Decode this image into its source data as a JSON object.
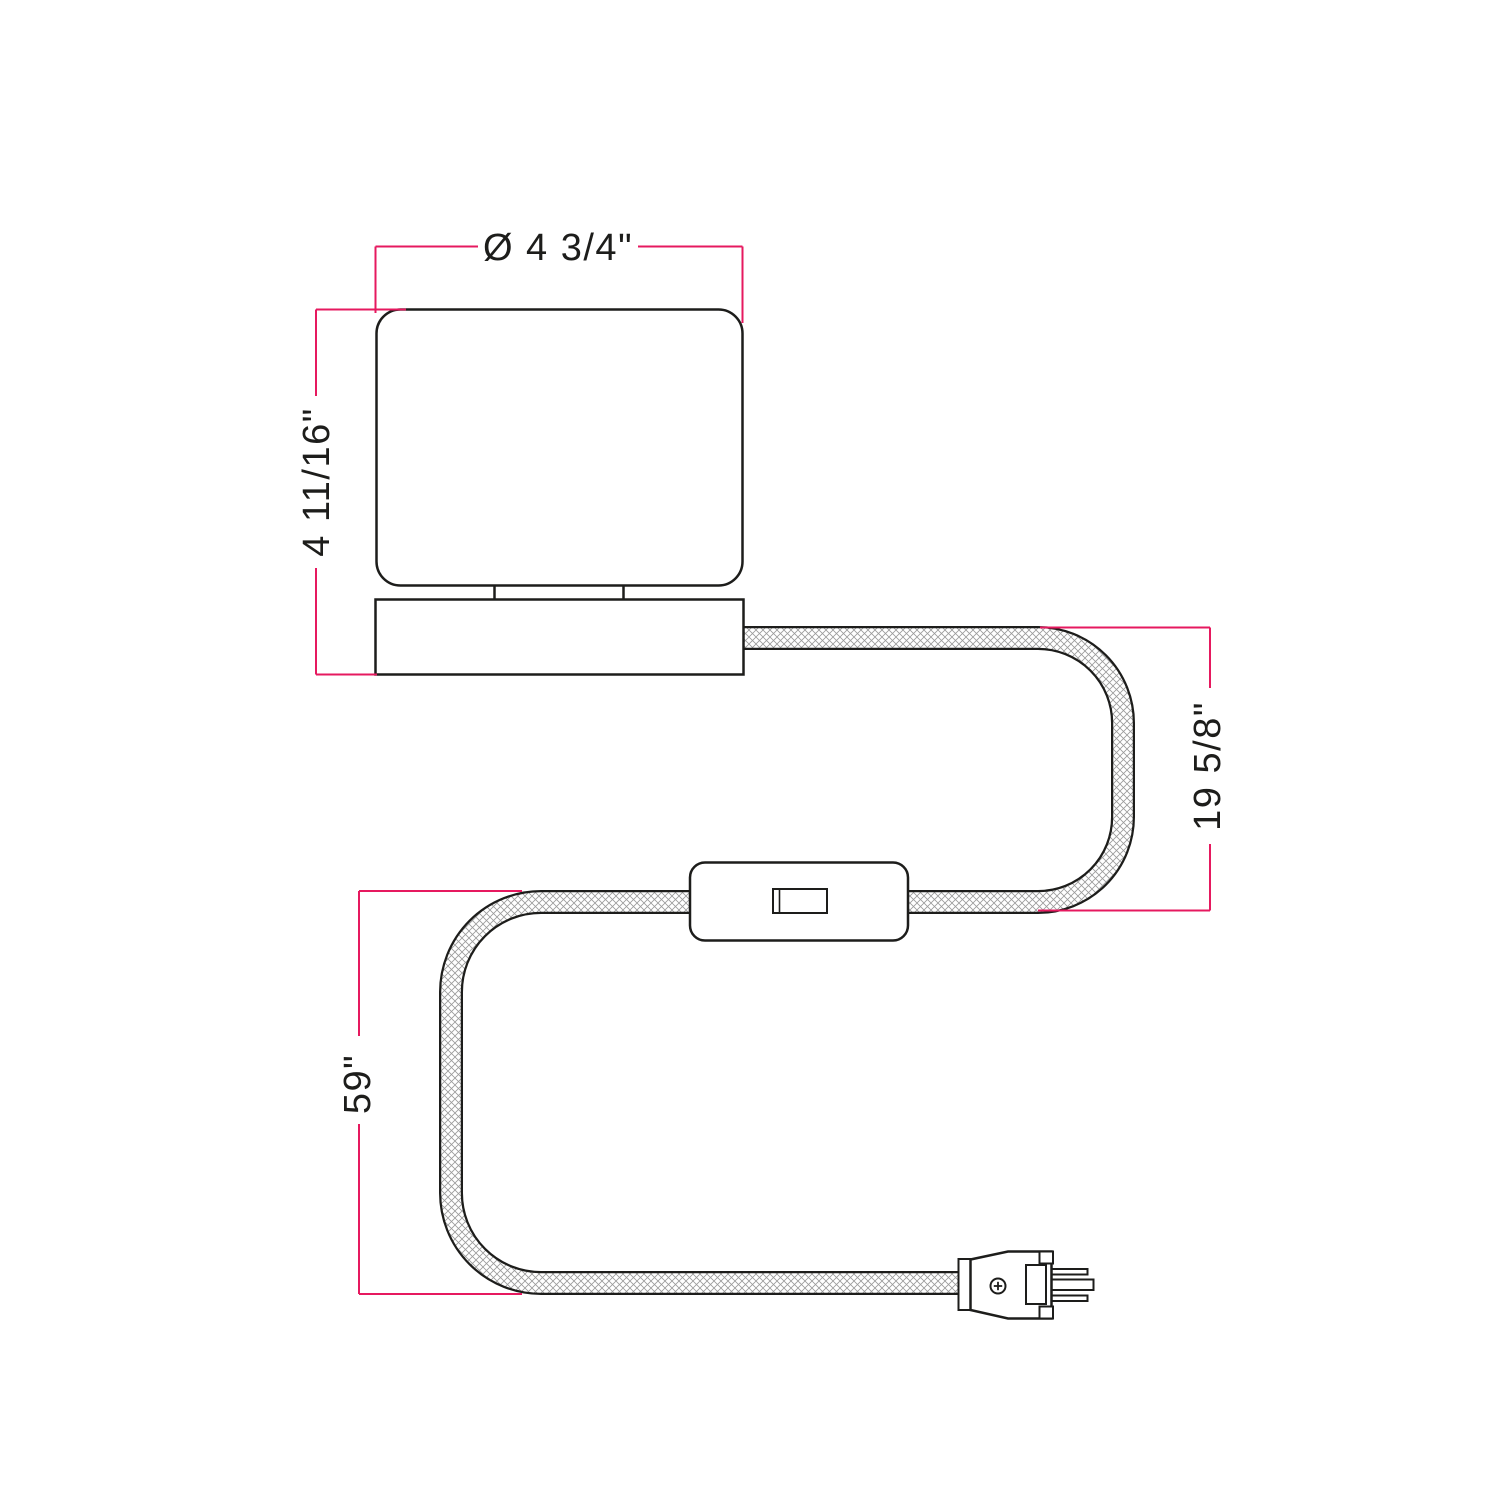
{
  "diagram": {
    "kind": "product-dimension-drawing",
    "product": "table lamp with fabric cord, inline switch and grounded plug",
    "colors": {
      "outline": "#1d1d1b",
      "dimension": "#e6195f",
      "cord_hatch": "#9a9a9a",
      "background": "#ffffff"
    },
    "dimensions": {
      "shade_diameter": {
        "label": "Ø 4 3/4\"",
        "orientation": "horizontal"
      },
      "lamp_height": {
        "label": "4 11/16\"",
        "orientation": "vertical"
      },
      "cord_drop": {
        "label": "19 5/8\"",
        "orientation": "vertical"
      },
      "cord_length": {
        "label": "59\"",
        "orientation": "vertical"
      }
    },
    "parts": {
      "shade": "cylindrical-lamp-shade",
      "base": "lamp-base",
      "cord": "braided-fabric-cord",
      "switch": "inline-rocker-switch",
      "plug": "us-grounded-plug"
    }
  }
}
